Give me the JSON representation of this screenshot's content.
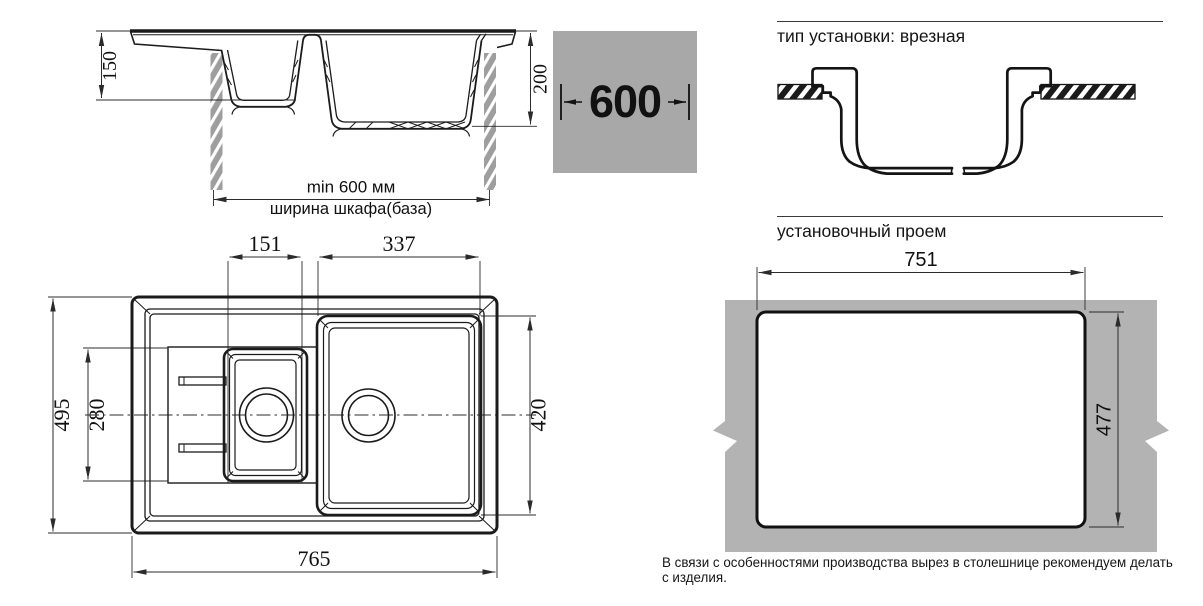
{
  "colors": {
    "badge_gray": "#a8a8a8",
    "slab_gray": "#b3b3b3",
    "cabinet_hatch_gray": "#9e9e9e",
    "line": "#1b1b1b"
  },
  "section_view": {
    "small_bowl_depth": "150",
    "main_bowl_depth": "200",
    "cabinet_min_width": "min 600 мм",
    "cabinet_width_label": "ширина шкафа(база)"
  },
  "size_badge": {
    "value": "600"
  },
  "install_type": {
    "title": "тип установки: врезная"
  },
  "top_view": {
    "small_bowl_width": "151",
    "main_bowl_width": "337",
    "length": "765",
    "width": "495",
    "small_bowl_length": "280",
    "main_bowl_length": "420"
  },
  "opening": {
    "title": "установочный проем",
    "width": "751",
    "height": "477",
    "note": "В связи с особенностями производства вырез в столешнице рекомендуем делать с изделия."
  }
}
